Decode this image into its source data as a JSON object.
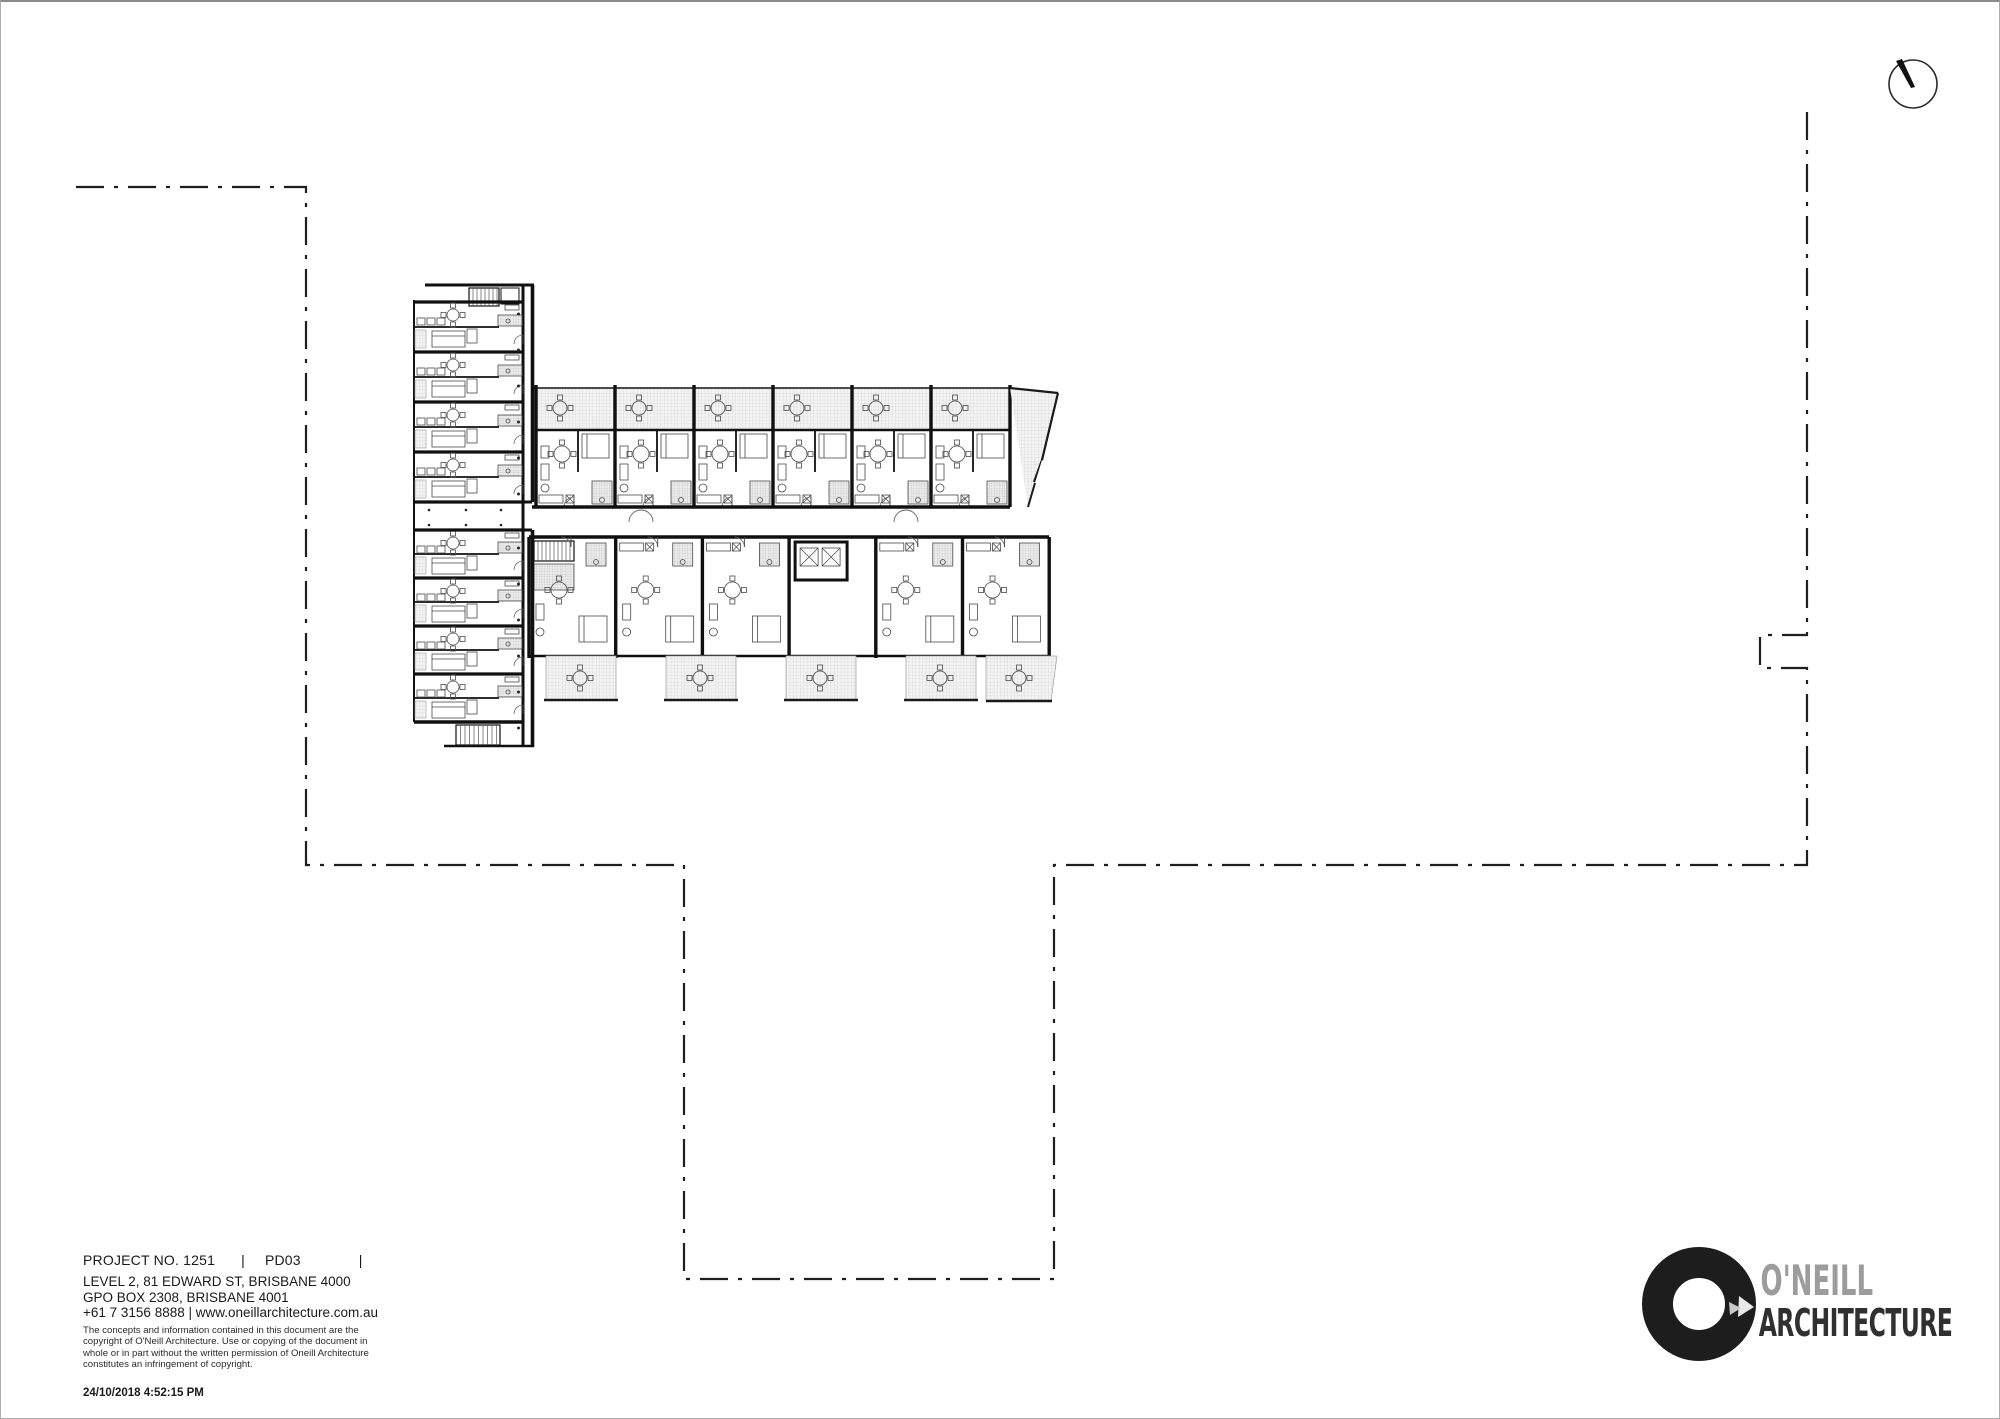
{
  "page": {
    "background": "#ffffff",
    "border_color": "#aeaeae"
  },
  "title_block": {
    "project_no": "PROJECT NO. 1251",
    "sep1": "|",
    "doc_code": "PD03",
    "sep2": "|",
    "address_line1": "LEVEL 2, 81 EDWARD ST, BRISBANE 4000",
    "address_line2": "GPO BOX 2308, BRISBANE 4001",
    "contact_line": "+61 7 3156 8888 | www.oneillarchitecture.com.au",
    "copyright_lines": [
      "The concepts and information contained in this document are the",
      "copyright of O'Neill Architecture. Use or copying of the document in",
      "whole or in part without the written permission of Oneill Architecture",
      "constitutes an infringement of copyright."
    ],
    "timestamp": "24/10/2018 4:52:15 PM"
  },
  "logo": {
    "name_top": "O'NEILL",
    "name_bottom": "ARCHITECTURE",
    "ring_color": "#1d1d1d",
    "name_top_color": "#9c9c9c",
    "name_bottom_color": "#303030"
  },
  "north_arrow": {
    "center": [
      1912,
      82
    ],
    "radius": 24,
    "needle_tip": [
      1896,
      60
    ]
  },
  "site_boundary": {
    "color": "#1f1f1f",
    "dash": "28 10 4 10",
    "points": [
      [
        75,
        185
      ],
      [
        305,
        185
      ],
      [
        305,
        863
      ],
      [
        683,
        863
      ],
      [
        683,
        1277
      ],
      [
        1053,
        1277
      ],
      [
        1053,
        863
      ],
      [
        1806,
        863
      ],
      [
        1806,
        666
      ],
      [
        1759,
        666
      ],
      [
        1759,
        633
      ],
      [
        1806,
        633
      ],
      [
        1806,
        102
      ]
    ]
  },
  "floor_plan": {
    "top_units": 6,
    "bottom_units": 6,
    "wing_modules_top": 4,
    "wing_modules_bottom": 4,
    "lift_count": 2,
    "colors": {
      "wall": "#101010",
      "detail": "#4a4a4a",
      "fine": "#8f8f8f",
      "edge": "#333333"
    }
  }
}
